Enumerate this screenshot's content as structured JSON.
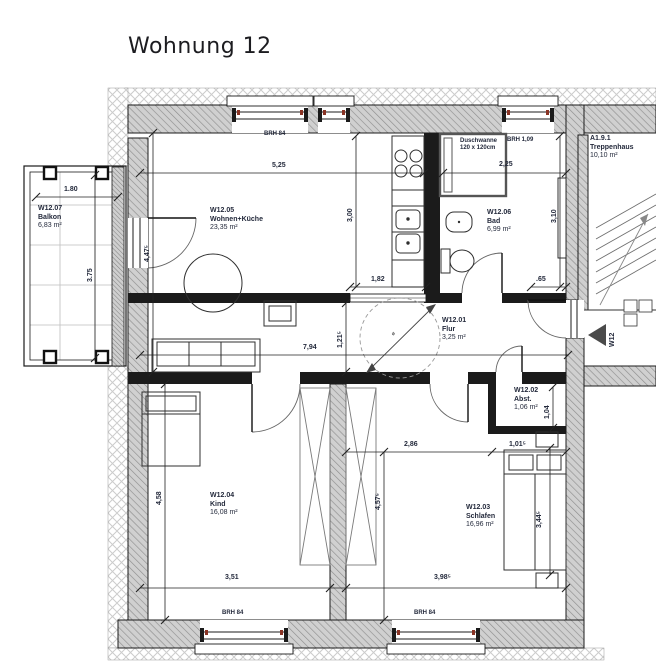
{
  "title": "Wohnung 12",
  "colors": {
    "text": "#242a3c",
    "line": "#1b1b1b",
    "wall_hatch": "#8f8f8f",
    "window_marker": "#8a3324"
  },
  "rooms": [
    {
      "id": "W12.07",
      "name": "Balkon",
      "area": "6,83 m²"
    },
    {
      "id": "W12.05",
      "name": "Wohnen+Küche",
      "area": "23,35 m²"
    },
    {
      "id": "W12.06",
      "name": "Bad",
      "area": "6,99 m²"
    },
    {
      "id": "A1.9.1",
      "name": "Treppenhaus",
      "area": "10,10 m²"
    },
    {
      "id": "W12.01",
      "name": "Flur",
      "area": "3,25 m²"
    },
    {
      "id": "W12.02",
      "name": "Abst.",
      "area": "1,06 m²"
    },
    {
      "id": "W12.04",
      "name": "Kind",
      "area": "16,08 m²"
    },
    {
      "id": "W12.03",
      "name": "Schlafen",
      "area": "16,96 m²"
    }
  ],
  "fixtures": {
    "shower_line1": "Duschwanne",
    "shower_line2": "120 x 120cm"
  },
  "windows": {
    "brh_top": "BRH 84",
    "brh_bad": "BRH 1,09",
    "brh_bottom_left": "BRH 84",
    "brh_bottom_right": "BRH 84"
  },
  "entrance": {
    "marker": "W12"
  },
  "misc": {
    "turning_circle": "ø"
  },
  "dims": {
    "balkon_w": "1.80",
    "balkon_h": "3.75",
    "wohnen_w": "5,25",
    "wohnen_h": "4,47⁵",
    "kueche_h": "3,00",
    "kueche_w": "1,82",
    "bad_w": "2,25",
    "bad_h": "3,10",
    "bad_rest": ".65",
    "flur_w": "7,94",
    "flur_h": "1,21⁵",
    "abst_h": "1,04",
    "abst_w": "1,01⁵",
    "kind_h": "4,58",
    "kind_w": "3,51",
    "mid_w": "2,86",
    "schlafen_d": "4,57⁵",
    "bett": "3,44⁵",
    "schlafen_w": "3,98⁵"
  }
}
